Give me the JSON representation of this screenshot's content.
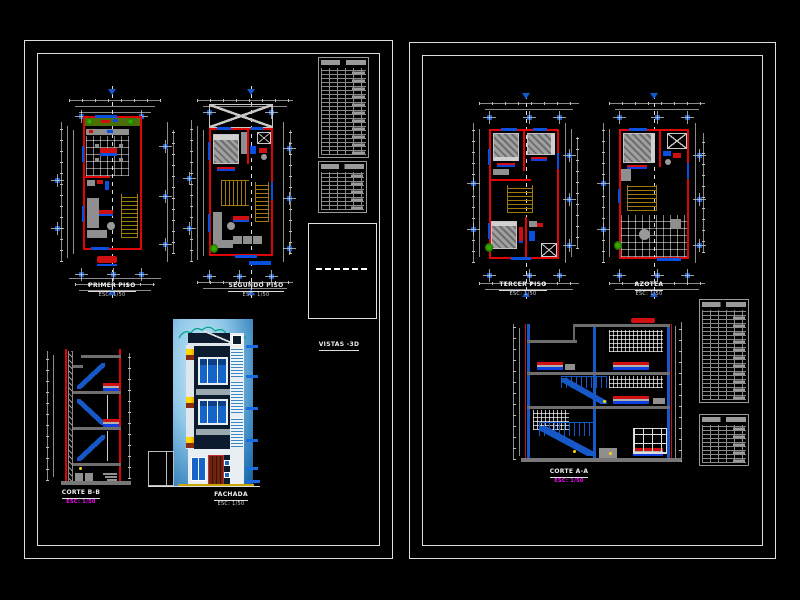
{
  "sheet_left": {
    "plans": [
      {
        "title": "PRIMER PISO",
        "scale": "ESC: 1/50"
      },
      {
        "title": "SEGUNDO PISO",
        "scale": "ESC: 1/50"
      }
    ],
    "views_box": {
      "label": "VISTAS -3D"
    },
    "section": {
      "title": "CORTE B-B",
      "scale": "ESC: 1/50"
    },
    "facade": {
      "title": "FACHADA",
      "scale": "ESC: 1/50"
    }
  },
  "sheet_right": {
    "plans": [
      {
        "title": "TERCER PISO",
        "scale": "ESC: 1/50"
      },
      {
        "title": "AZOTEA",
        "scale": "ESC: 1/50"
      }
    ],
    "section": {
      "title": "CORTE A-A",
      "scale": "ESC: 1/50"
    }
  },
  "colors": {
    "background": "#000000",
    "sheet_border": "#dddddd",
    "wall_red": "#e00505",
    "detail_blue": "#0a50e0",
    "grid_marker_blue": "#1758c8",
    "stair_gold": "#a07a0c",
    "furniture_gray": "#8f8f8f",
    "table_gray": "#9a9a9a",
    "scale_magenta": "#ff00ff",
    "plant_green": "#2f9e00",
    "sky_light": "#cfeaf8",
    "sky_dark": "#155d94",
    "flower_yellow": "#ffd800",
    "door_brown": "#6f2410"
  }
}
